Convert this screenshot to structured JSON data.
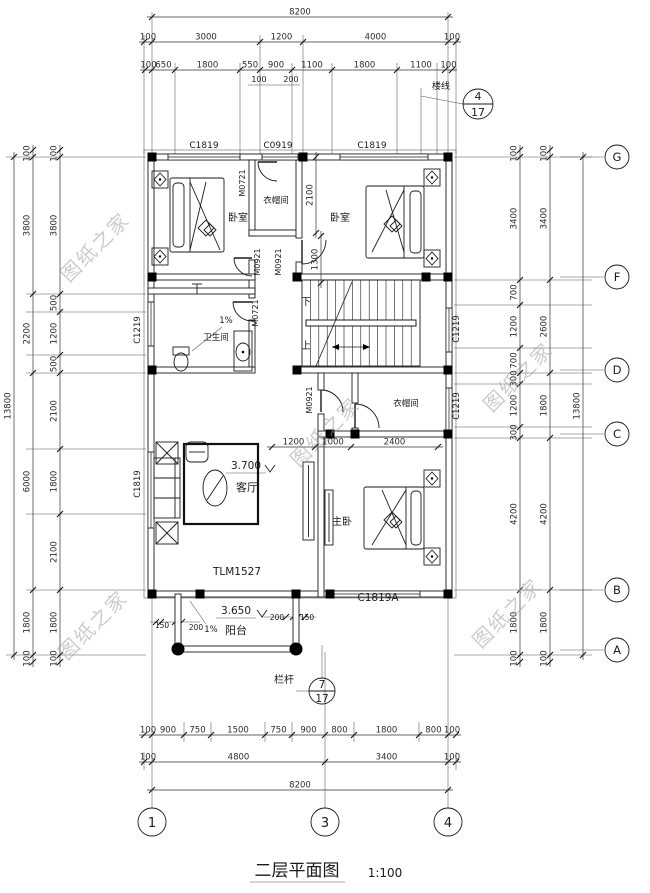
{
  "title": {
    "name": "二层平面图",
    "scale": "1:100"
  },
  "watermark": "图纸之家",
  "grid_bubbles": {
    "bottom": [
      "1",
      "3",
      "4"
    ],
    "right": [
      "G",
      "F",
      "D",
      "C",
      "B",
      "A"
    ]
  },
  "callouts": {
    "top": {
      "num": "4",
      "den": "17",
      "note": "楼线"
    },
    "bottom": {
      "num": "7",
      "den": "17"
    }
  },
  "rooms": {
    "bedroom_left": "卧室",
    "bedroom_right": "卧室",
    "closet_top": "衣帽间",
    "closet_mid": "衣帽间",
    "bathroom": "卫生间",
    "living": "客厅",
    "master": "主卧",
    "balcony": "阳台",
    "railing": "栏杆",
    "stairs_down": "下",
    "stairs_up": "上"
  },
  "levels": {
    "living": "3.700",
    "balcony": "3.650"
  },
  "slopes": {
    "bathroom": "1%",
    "balcony": "1%"
  },
  "openings": {
    "win_top_left": "C1819",
    "win_top_mid": "C0919",
    "win_top_right": "C1819",
    "win_left_bath": "C1219",
    "win_left_living": "C1819",
    "win_right_stair": "C1219",
    "win_right_closet": "C1219",
    "door_closet_top": "M0721",
    "door_bed_left": "M0921",
    "door_bed_right": "M0921",
    "door_bath": "M0721",
    "door_master": "M0921",
    "balcony_door": "TLM1527",
    "win_bottom_right": "C1819A"
  },
  "dims": {
    "top": {
      "row1": [
        "8200"
      ],
      "row2": [
        "100",
        "3000",
        "1200",
        "4000",
        "100"
      ],
      "row3": [
        "100",
        "650",
        "1800",
        "550",
        "900",
        "1100",
        "1800",
        "1100",
        "100"
      ],
      "sub": [
        "100",
        "200"
      ]
    },
    "bottom": {
      "row1": [
        "100",
        "900",
        "750",
        "1500",
        "750",
        "900",
        "800",
        "1800",
        "800",
        "100"
      ],
      "row2": [
        "100",
        "4800",
        "3400",
        "100"
      ],
      "row3": [
        "8200"
      ]
    },
    "left": {
      "inner": [
        "100",
        "3800",
        "500",
        "1200",
        "500",
        "2100",
        "1800",
        "2100",
        "1800",
        "100"
      ],
      "mid": [
        "100",
        "3800",
        "2200",
        "6000",
        "1800",
        "100"
      ],
      "total": [
        "13800"
      ]
    },
    "right": {
      "inner": [
        "100",
        "3400",
        "700",
        "1200",
        "700",
        "300",
        "1200",
        "300",
        "4200",
        "1800",
        "100"
      ],
      "mid": [
        "100",
        "3400",
        "2600",
        "1800",
        "4200",
        "1800",
        "100"
      ],
      "total": [
        "13800"
      ]
    },
    "interior": {
      "closet_row": [
        "1200",
        "1000",
        "2400"
      ],
      "closet_h": [
        "2100"
      ],
      "door_h": [
        "1300"
      ],
      "balcony_left": [
        "150",
        "200"
      ],
      "balcony_right": [
        "200",
        "150"
      ]
    }
  }
}
